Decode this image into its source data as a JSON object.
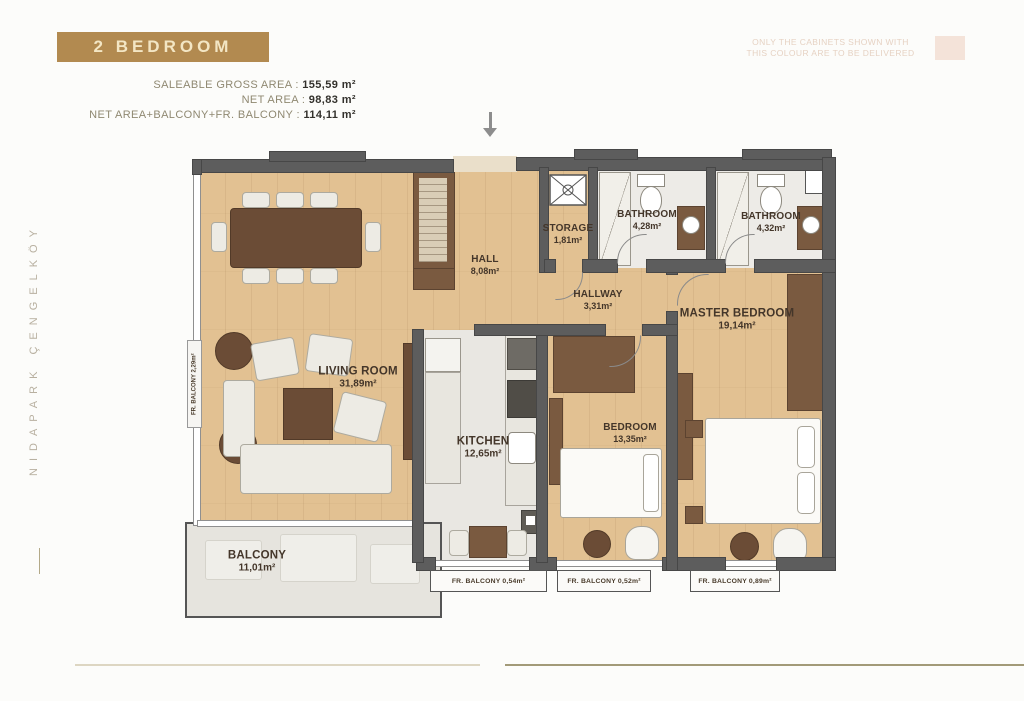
{
  "header": {
    "title": "2 BEDROOM",
    "areas": [
      {
        "label": "SALEABLE GROSS AREA",
        "sep": " : ",
        "value": "155,59 m²"
      },
      {
        "label": "NET AREA",
        "sep": " : ",
        "value": "98,83 m²"
      },
      {
        "label": "NET AREA+BALCONY+FR. BALCONY",
        "sep": " : ",
        "value": "114,11 m²"
      }
    ],
    "disclaimer": {
      "line1": "ONLY THE CABINETS SHOWN WITH",
      "line2": "THIS COLOUR ARE TO BE DELIVERED"
    }
  },
  "watermark": "NIDAPARK ÇENGELKÖY",
  "plan": {
    "rooms": {
      "living": {
        "name": "LIVING ROOM",
        "area": "31,89m²"
      },
      "hall": {
        "name": "HALL",
        "area": "8,08m²"
      },
      "hallway": {
        "name": "HALLWAY",
        "area": "3,31m²"
      },
      "storage": {
        "name": "STORAGE",
        "area": "1,81m²"
      },
      "bathroom1": {
        "name": "BATHROOM",
        "area": "4,28m²"
      },
      "bathroom2": {
        "name": "BATHROOM",
        "area": "4,32m²"
      },
      "master": {
        "name": "MASTER BEDROOM",
        "area": "19,14m²"
      },
      "kitchen": {
        "name": "KITCHEN",
        "area": "12,65m²"
      },
      "bedroom": {
        "name": "BEDROOM",
        "area": "13,35m²"
      },
      "balcony": {
        "name": "BALCONY",
        "area": "11,01m²"
      }
    },
    "fr_balconies": {
      "side": "FR. BALCONY 2,29m²",
      "kitchen": "FR. BALCONY 0,54m²",
      "bedroom": "FR. BALCONY 0,52m²",
      "master": "FR. BALCONY 0,89m²"
    }
  },
  "colors": {
    "accent_gold": "#b28a50",
    "wall_gray": "#5d5d5d",
    "wood_floor": "#e2c192",
    "cabinet_swatch": "#f4e3d9",
    "footer_rule": "#a29a78"
  }
}
